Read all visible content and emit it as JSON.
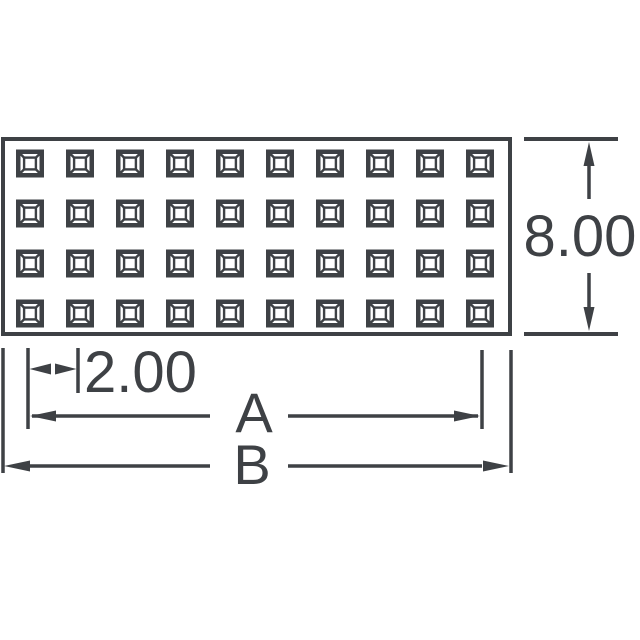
{
  "drawing": {
    "title": "connector-footprint-technical-drawing",
    "ink_color": "#3e4145",
    "background_color": "#ffffff",
    "body": {
      "shape": "rectangle",
      "contact_style": "square-frustum-pad",
      "grid": {
        "rows": 4,
        "cols": 10,
        "total_contacts": 40
      }
    },
    "dimensions": {
      "height_label": "8.00",
      "pitch_label": "2.00",
      "inner_width_label": "A",
      "overall_width_label": "B"
    }
  }
}
